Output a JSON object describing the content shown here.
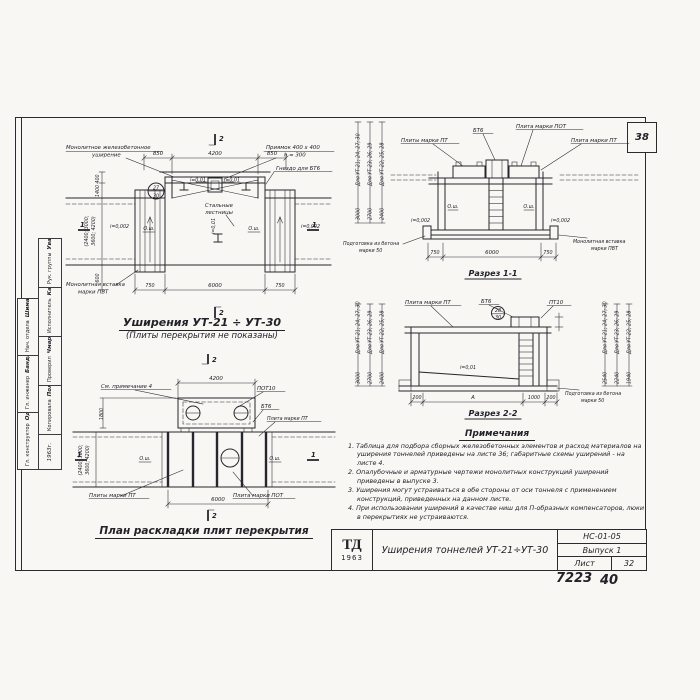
{
  "sheet": {
    "corner_number": "38",
    "footer_left": "7223",
    "footer_right": "40"
  },
  "titleblock": {
    "logo": "ТД",
    "logo_year": "1963",
    "title": "Уширения тоннелей УТ-21÷УТ-30",
    "doc_code": "НС-01-05",
    "issue": "Выпуск 1",
    "sheet_word": "Лист",
    "sheet_number": "32"
  },
  "stamp": {
    "outer_rows": [
      {
        "role": "Нач. отдела",
        "name": "Шиманвицкий"
      },
      {
        "role": "Гл. инженер",
        "name": "Бандюк"
      },
      {
        "role": "Гл. конструктор",
        "name": "Одобнистый"
      }
    ],
    "inner_rows": [
      {
        "role": "Рук. группы",
        "name": "Уваровский"
      },
      {
        "role": "Исполнитель",
        "name": "Каганюк"
      },
      {
        "role": "Проверил",
        "name": "Чмарин"
      },
      {
        "role": "Копировала",
        "name": "Полякова"
      }
    ],
    "year": "1963г."
  },
  "plan": {
    "title": "Уширения УТ-21 ÷ УТ-30",
    "subtitle": "(Плиты перекрытия не показаны)",
    "labels": {
      "monolithic_1": "Монолитное железобетонное",
      "monolithic_2": "уширение",
      "pit_1": "Приямок 400 x 400",
      "pit_2": "h = 300",
      "socket": "Гнездо для БТ6",
      "ladders_1": "Стальные",
      "ladders_2": "лестницы",
      "insert_1": "Монолитная вставка",
      "insert_2": "марки ПВТ",
      "axis_left": "О.ш.",
      "axis_right": "О.ш.",
      "slope_pit_left": "i=0,01",
      "slope_pit_right": "i=0,01",
      "slope_axis": "i=0,01",
      "slope_left": "i=0,002",
      "slope_right": "i=0,002",
      "marker_top": "27",
      "marker_bottom": "30"
    },
    "dims": {
      "top_left": "850",
      "top_mid": "4200",
      "top_right": "850",
      "bottom_left": "750",
      "bottom_mid": "6000",
      "bottom_right": "750",
      "left_1": "400",
      "left_2": "1400",
      "left_3": "(2400; 3000;",
      "left_4": "3600; 4200)",
      "left_5": "600"
    },
    "marks": {
      "s1": "1",
      "s2": "2"
    }
  },
  "section1": {
    "title": "Разрез 1-1",
    "labels": {
      "bt6": "БТ6",
      "pot": "Плита марки ПОТ",
      "pt_left": "Плиты марки ПТ",
      "pt_right": "Плита марки ПТ",
      "prep_1": "Подготовка из бетона",
      "prep_2": "марки 50",
      "insert_1": "Монолитная вставка",
      "insert_2": "марки ПВТ",
      "axis_left": "О.ш.",
      "axis_right": "О.ш.",
      "slope_left": "i=0,002",
      "slope_right": "i=0,002"
    },
    "left_dims": [
      {
        "label": "Для УТ-21; 24; 27; 30",
        "value": "3000"
      },
      {
        "label": "Для УТ-23; 26; 29",
        "value": "2700"
      },
      {
        "label": "Для УТ-22; 25; 28",
        "value": "2400"
      }
    ],
    "bottom_dims": {
      "left": "750",
      "mid": "6000",
      "right": "750"
    }
  },
  "section2": {
    "title": "Разрез 2-2",
    "labels": {
      "pt": "Плита марки ПТ",
      "bt6": "БТ6",
      "pt10": "ПТ10",
      "slope": "i=0,01",
      "prep_1": "Подготовка из бетона",
      "prep_2": "марки 50",
      "marker_top": "28",
      "marker_bottom": "30"
    },
    "left_dims": [
      {
        "label": "Для УТ-21; 24; 27; 30",
        "value": "3000"
      },
      {
        "label": "Для УТ-23; 26; 29",
        "value": "2700"
      },
      {
        "label": "Для УТ-22; 25; 28",
        "value": "2400"
      }
    ],
    "right_dims": [
      {
        "label": "Для УТ-21; 24; 27; 30",
        "value": "2540"
      },
      {
        "label": "Для УТ-23; 26; 29",
        "value": "2240"
      },
      {
        "label": "Для УТ-22; 25; 28",
        "value": "1940"
      }
    ],
    "bottom_dims": {
      "d1": "200",
      "d2": "А",
      "d3": "1000",
      "d4": "200"
    }
  },
  "layout_plan": {
    "title": "План раскладки плит перекрытия",
    "labels": {
      "see_note": "См. примечание 4",
      "pot10": "ПОТ10",
      "bt6": "БТ6",
      "pt": "Плита марки ПТ",
      "pt_plural": "Плиты марки ПТ",
      "pot": "Плита марки ПОТ",
      "axis_left": "О.ш.",
      "axis_right": "О.ш."
    },
    "dims": {
      "top": "4200",
      "bottom": "6000",
      "left_top": "1800",
      "left_mid_1": "(2400; 3000;",
      "left_mid_2": "3600; 4200)"
    },
    "marks": {
      "s1": "1",
      "s2": "2"
    }
  },
  "notes": {
    "heading": "Примечания",
    "items": [
      "1. Таблица для подбора сборных железобетонных элементов и расход материалов на уширения тоннелей приведены на листе 36; габаритные схемы уширений - на листе 4.",
      "2. Опалубочные и арматурные чертежи монолитных конструкций уширений приведены в выпуске 3.",
      "3. Уширения могут устраиваться в обе стороны от оси тоннеля с применением конструкций, приведенных на данном листе.",
      "4. При использовании уширений в качестве ниш для П-образных компенсаторов, люки в перекрытиях не устраиваются."
    ]
  }
}
